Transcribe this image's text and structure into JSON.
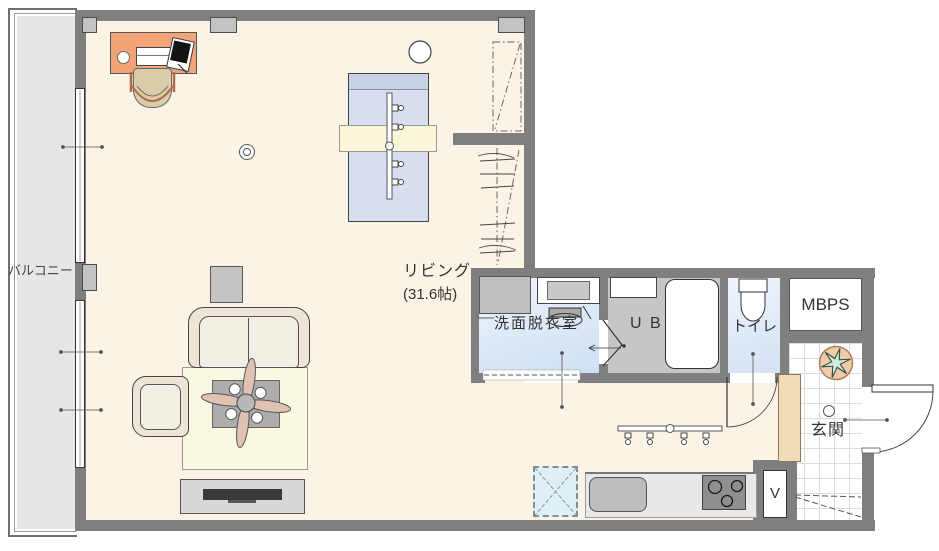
{
  "floorplan": {
    "title": "1R apartment floor plan",
    "labels": {
      "balcony": "バルコニー",
      "living": "リビング",
      "living_size": "(31.6帖)",
      "washroom": "洗面脱衣室",
      "unit_bath": "U B",
      "toilet": "トイレ",
      "meter_box": "MBPS",
      "entrance": "玄関",
      "vent": "V"
    },
    "colors": {
      "wall": "#7f7f7f",
      "living_floor": "#faf3e6",
      "balcony_floor": "#e6e6e6",
      "washroom_floor": "#dce8f6",
      "bath_floor": "#c6c6c6",
      "entrance_tile": "#ffffff",
      "desk": "#f2a377",
      "bed": "#d8deef",
      "rug": "#fbf8e2",
      "bed_throw": "#faf7d8",
      "fridge_space": "#def0f6",
      "shoe_cabinet": "#f0ddb6",
      "plant_pot": "#f0cbaa",
      "plant_leaf": "#d4eadc"
    }
  }
}
